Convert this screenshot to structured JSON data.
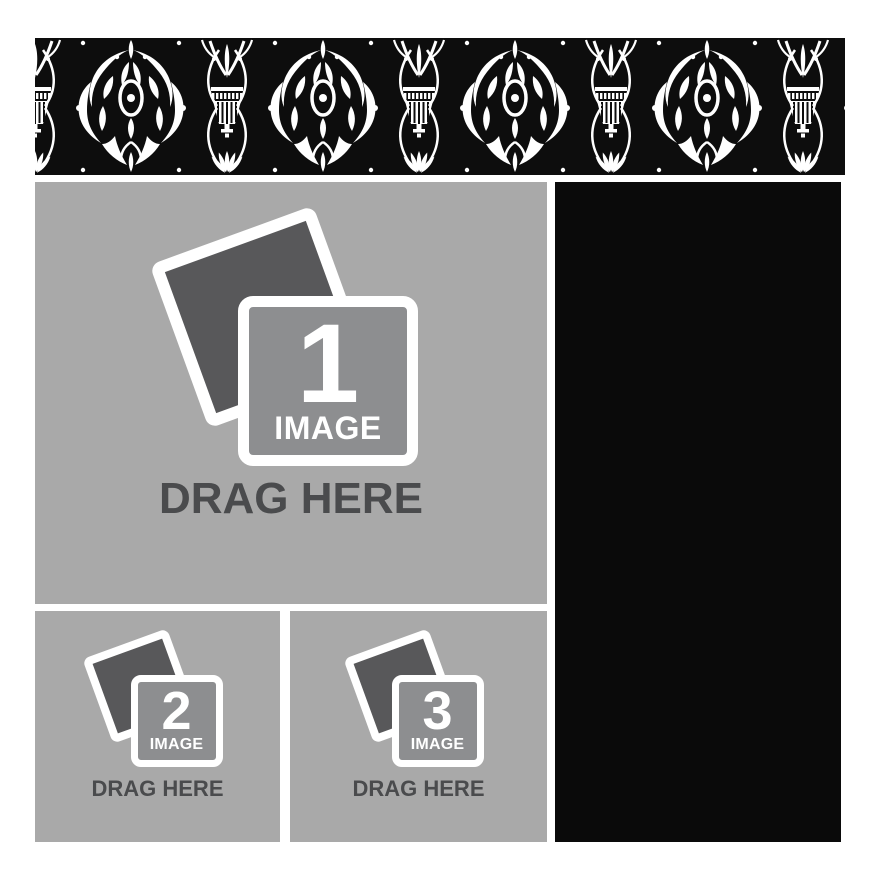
{
  "canvas": {
    "width": 882,
    "height": 882,
    "background": "#ffffff"
  },
  "damask_border": {
    "description": "black and white ornate damask pattern border strip",
    "bg_color": "#0d0d0d",
    "motif_color": "#ffffff"
  },
  "zones": [
    {
      "number": "1",
      "image_label": "IMAGE",
      "drag_label": "DRAG HERE"
    },
    {
      "number": "2",
      "image_label": "IMAGE",
      "drag_label": "DRAG HERE"
    },
    {
      "number": "3",
      "image_label": "IMAGE",
      "drag_label": "DRAG HERE"
    }
  ],
  "right_panel": {
    "color": "#0a0a0a"
  },
  "colors": {
    "zone_bg": "#a9a9a9",
    "icon_front_bg": "#8d8e90",
    "icon_back_bg": "#58585a",
    "drag_text": "#4a4b4d",
    "label_text": "#ffffff"
  }
}
